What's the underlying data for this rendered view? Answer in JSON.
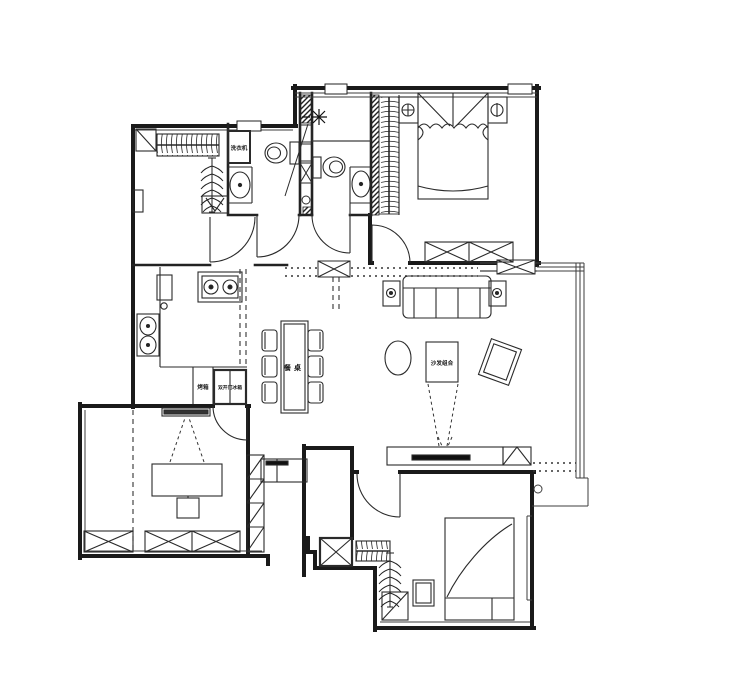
{
  "document": {
    "type": "residential floor plan (CAD style)",
    "language": "zh-CN"
  },
  "colors": {
    "background": "#ffffff",
    "wall_line": "#1a1a1a",
    "detail_line": "#3d3d3d",
    "solid_fill": "#111111"
  },
  "labels": {
    "washing_machine": "洗衣机",
    "oven": "烤箱",
    "fridge": "双开门冰箱",
    "dining_table": "餐桌",
    "sofa_group": "沙发组合"
  },
  "icons": [
    {
      "name": "wall-light-icon",
      "shape": "asterisk ✳"
    },
    {
      "name": "ceiling-lamp-icon",
      "shape": "circle-crosshair ⊕"
    },
    {
      "name": "table-lamp-icon",
      "shape": "circle-bar ⊖"
    },
    {
      "name": "plant-swirl-icon",
      "shape": "spiral dot"
    },
    {
      "name": "gas-stove-icon",
      "shape": "two burner circles"
    },
    {
      "name": "kitchen-sink-icon",
      "shape": "double bowl"
    },
    {
      "name": "toilet-icon",
      "shape": "oval bowl + tank"
    },
    {
      "name": "wash-basin-icon",
      "shape": "oval + faucet dot"
    },
    {
      "name": "hanger-rod-icon",
      "shape": "comb strokes"
    },
    {
      "name": "clothes-tree-icon",
      "shape": "branched spine"
    },
    {
      "name": "floor-drain-icon",
      "shape": "small circle"
    },
    {
      "name": "projection-beam-icon",
      "shape": "dashed V lines"
    }
  ]
}
